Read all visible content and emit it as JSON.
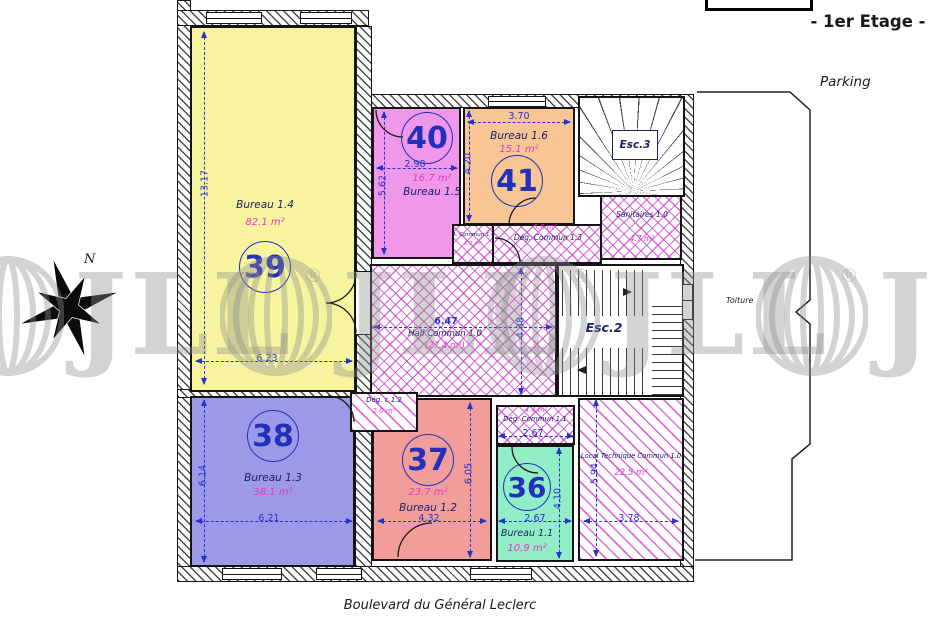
{
  "page": {
    "floor_title": "- 1er Etage -",
    "parking_label": "Parking",
    "street_label": "Boulevard du Général Leclerc",
    "toiture_label": "Toiture",
    "north_label": "N"
  },
  "watermark": {
    "brand": "JLL",
    "registered": "®"
  },
  "stairwells": {
    "esc2": "Esc.2",
    "esc3": "Esc.3"
  },
  "rooms": [
    {
      "number": "39",
      "name": "Bureau 1.4",
      "area": "82.1 m²",
      "width_m": "6.23",
      "height_m": "13.17",
      "fill": "#f7f39e"
    },
    {
      "number": "40",
      "name": "Bureau 1.5",
      "area": "16.7 m²",
      "width_m": "2.98",
      "height_m": "5.62",
      "fill": "#ef97e9"
    },
    {
      "number": "41",
      "name": "Bureau 1.6",
      "area": "15.1 m²",
      "width_m": "3.70",
      "height_m": "4.20",
      "fill": "#f7c694"
    },
    {
      "number": "38",
      "name": "Bureau 1.3",
      "area": "38.1 m²",
      "width_m": "6.21",
      "height_m": "6.14",
      "fill": "#9c9ae8"
    },
    {
      "number": "37",
      "name": "Bureau 1.2",
      "area": "23.7 m²",
      "width_m": "4.32",
      "height_m": "6.05",
      "fill": "#f19e9a"
    },
    {
      "number": "36",
      "name": "Bureau 1.1",
      "area": "10.9 m²",
      "width_m": "2.67",
      "height_m": "4.10",
      "fill": "#90edc5"
    }
  ],
  "common_areas": {
    "hall": {
      "name": "Hall Commun 1.0",
      "area": "(27.4 m²)",
      "width_m": "6.47",
      "height_m": "4.38"
    },
    "deg_commun_13": {
      "name": "Dég. Commun 1.3",
      "area": "5.6 m²"
    },
    "deg_commun_11": {
      "name": "Dég. Commun 1.1",
      "area": "4.4 m²",
      "width_m": "2.67"
    },
    "deg_c_12": {
      "name": "Dég. c 1.2",
      "area": "2.0 m²"
    },
    "sanitaires": {
      "name": "Sanitaires 1.0",
      "area": "4.7 m²"
    },
    "asc_commun": {
      "name": "A. Commun 1.0",
      "area": "1.7 m²"
    },
    "local_technique": {
      "name": "Local Technique Commun 1.0",
      "area": "22.5 m²",
      "width_m": "3.78",
      "height_m": "5.94"
    }
  },
  "colors": {
    "dimension_blue": "#2633cc",
    "area_pink": "#e838c8",
    "label_blue": "#1c2168",
    "hatch_magenta": "#cc3ecc",
    "wall_black": "#141414"
  }
}
